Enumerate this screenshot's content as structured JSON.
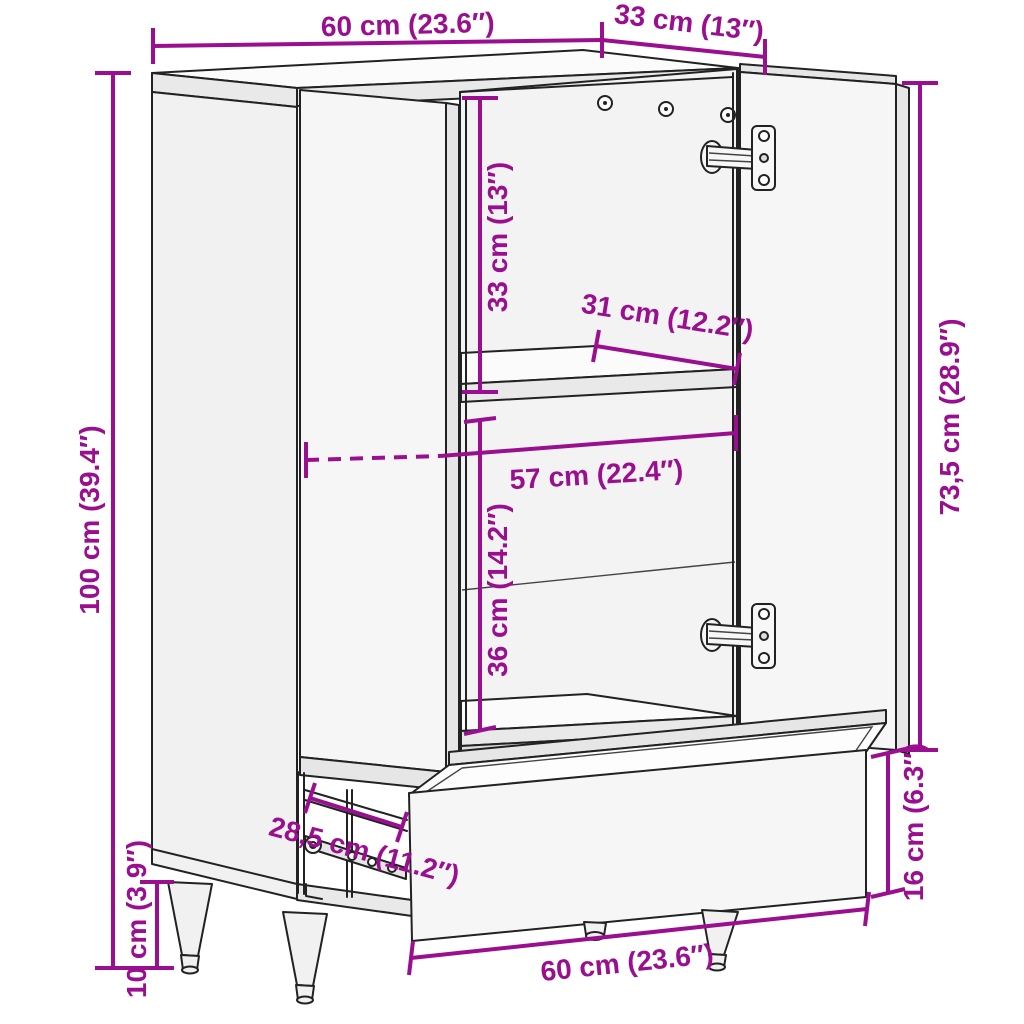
{
  "colors": {
    "dimension": "#9A0F8F",
    "line_art": "#222222",
    "background": "#ffffff"
  },
  "dimensions": {
    "top_width": "60 cm (23.6″)",
    "top_depth": "33 cm (13″)",
    "total_height": "100 cm (39.4″)",
    "upper_compartment_height": "33 cm (13″)",
    "shelf_depth": "31 cm (12.2″)",
    "interior_width": "57 cm (22.4″)",
    "lower_compartment_height": "36 cm (14.2″)",
    "door_height": "73,5 cm (28.9″)",
    "drawer_front_height": "16 cm (6.3″)",
    "drawer_slide_length": "28,5 cm (11.2″)",
    "leg_height": "10 cm (3.9″)",
    "drawer_width": "60 cm (23.6″)"
  }
}
